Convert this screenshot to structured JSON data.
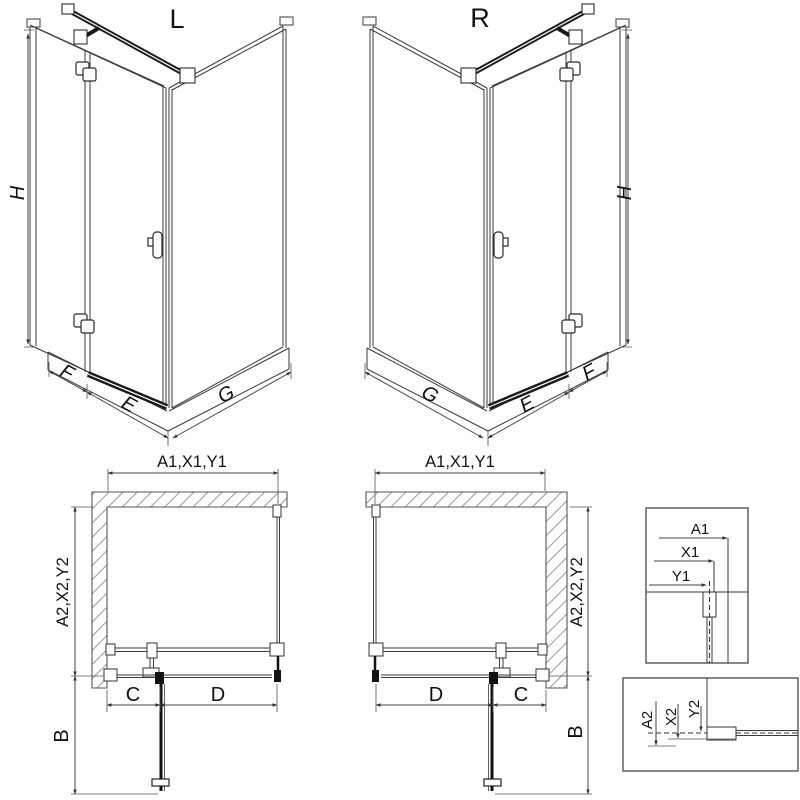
{
  "title": "Shower enclosure technical drawing",
  "colors": {
    "background": "#ffffff",
    "line": "#3a3a3a",
    "dark_profile": "#1a1a1a",
    "dimension": "#444444",
    "hatch": "#999999"
  },
  "iso_left": {
    "label": "L",
    "height": "H",
    "fixed": "F",
    "door": "E",
    "side": "G"
  },
  "iso_right": {
    "label": "R",
    "height": "H",
    "fixed": "F",
    "door": "E",
    "side": "G"
  },
  "plan_left": {
    "top": "A1,X1,Y1",
    "side": "A2,X2,Y2",
    "fixed": "C",
    "door": "D",
    "swing": "B"
  },
  "plan_right": {
    "top": "A1,X1,Y1",
    "side": "A2,X2,Y2",
    "fixed": "C",
    "door": "D",
    "swing": "B"
  },
  "detail_top": {
    "a": "A1",
    "x": "X1",
    "y": "Y1"
  },
  "detail_bottom": {
    "a": "A2",
    "x": "X2",
    "y": "Y2"
  }
}
